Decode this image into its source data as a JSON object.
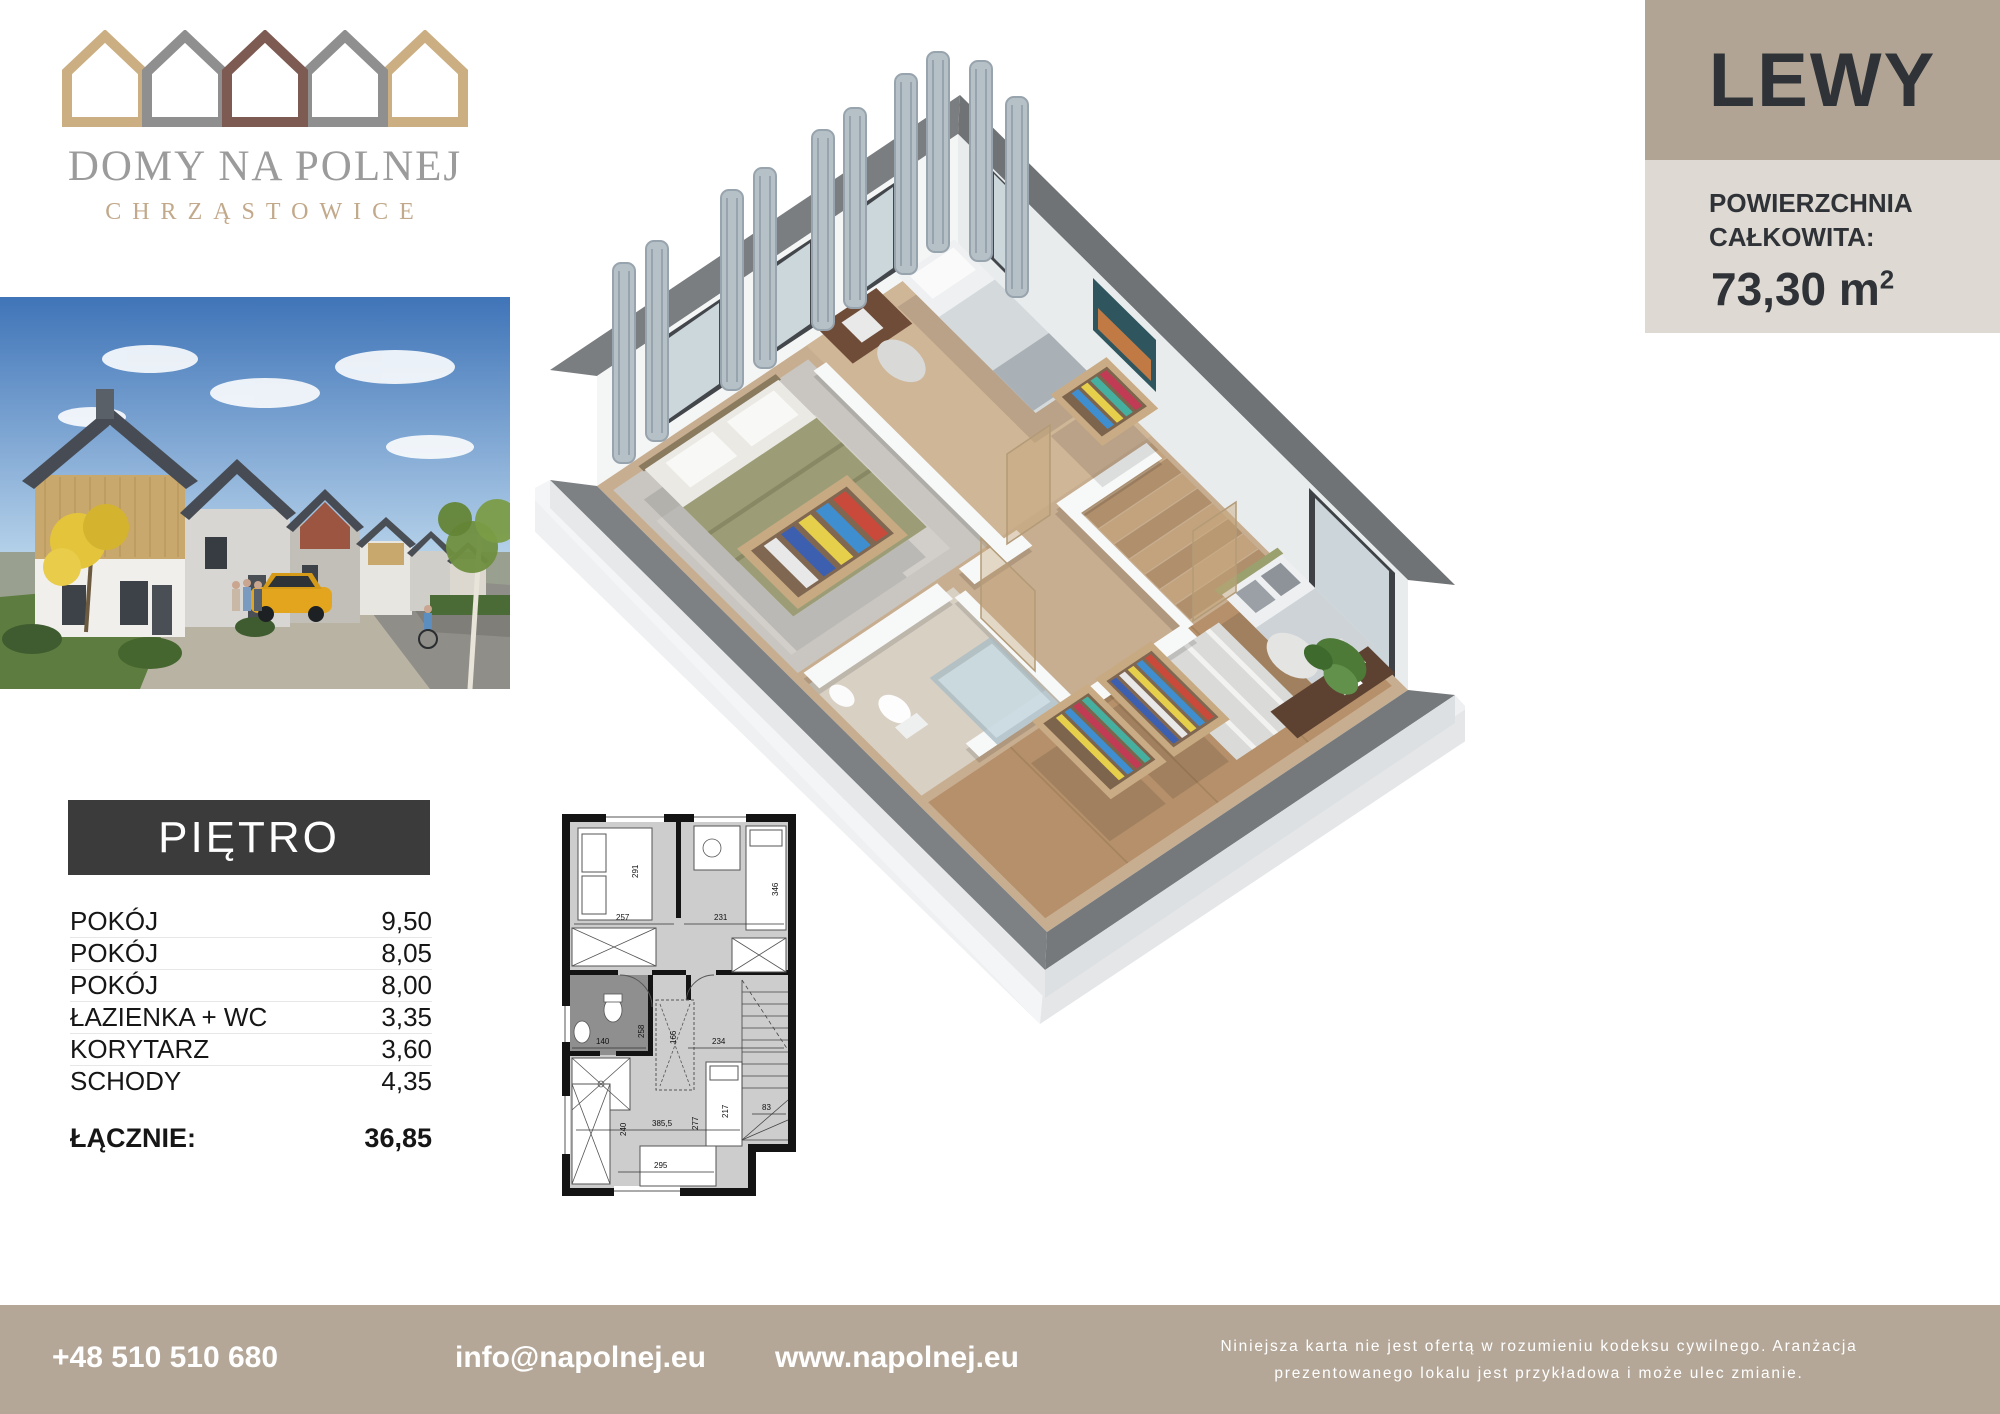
{
  "brand": {
    "name": "DOMY NA POLNEJ",
    "location": "CHRZĄSTOWICE"
  },
  "unit": {
    "name": "LEWY",
    "area_label_line1": "POWIERZCHNIA",
    "area_label_line2": "CAŁKOWITA:",
    "area_value": "73,30 m",
    "area_unit_sup": "2"
  },
  "floor": {
    "title": "PIĘTRO",
    "rows": [
      {
        "label": "POKÓJ",
        "value": "9,50"
      },
      {
        "label": "POKÓJ",
        "value": "8,05"
      },
      {
        "label": "POKÓJ",
        "value": "8,00"
      },
      {
        "label": "ŁAZIENKA + WC",
        "value": "3,35"
      },
      {
        "label": "KORYTARZ",
        "value": "3,60"
      },
      {
        "label": "SCHODY",
        "value": "4,35"
      }
    ],
    "total_label": "ŁĄCZNIE:",
    "total_value": "36,85"
  },
  "plan2d": {
    "dims": {
      "d291": "291",
      "d257": "257",
      "d231": "231",
      "d346": "346",
      "d140": "140",
      "d258": "258",
      "d166": "166",
      "d234": "234",
      "d240": "240",
      "d385": "385,5",
      "d277": "277",
      "d217": "217",
      "d295": "295",
      "d83": "83"
    }
  },
  "footer": {
    "phone": "+48 510 510 680",
    "email": "info@napolnej.eu",
    "website": "www.napolnej.eu",
    "disclaimer_line1": "Niniejsza karta nie jest ofertą w rozumieniu kodeksu cywilnego. Aranżacja",
    "disclaimer_line2": "prezentowanego lokalu jest przykładowa i może ulec zmianie."
  },
  "colors": {
    "accent_beige": "#b4a798",
    "panel_beige": "#b1a495",
    "panel_light": "#dedad3",
    "dark_box": "#3b3b3b",
    "logo_tan": "#cbae81",
    "logo_gray": "#8f8f8f",
    "logo_brown": "#7d5a52"
  }
}
